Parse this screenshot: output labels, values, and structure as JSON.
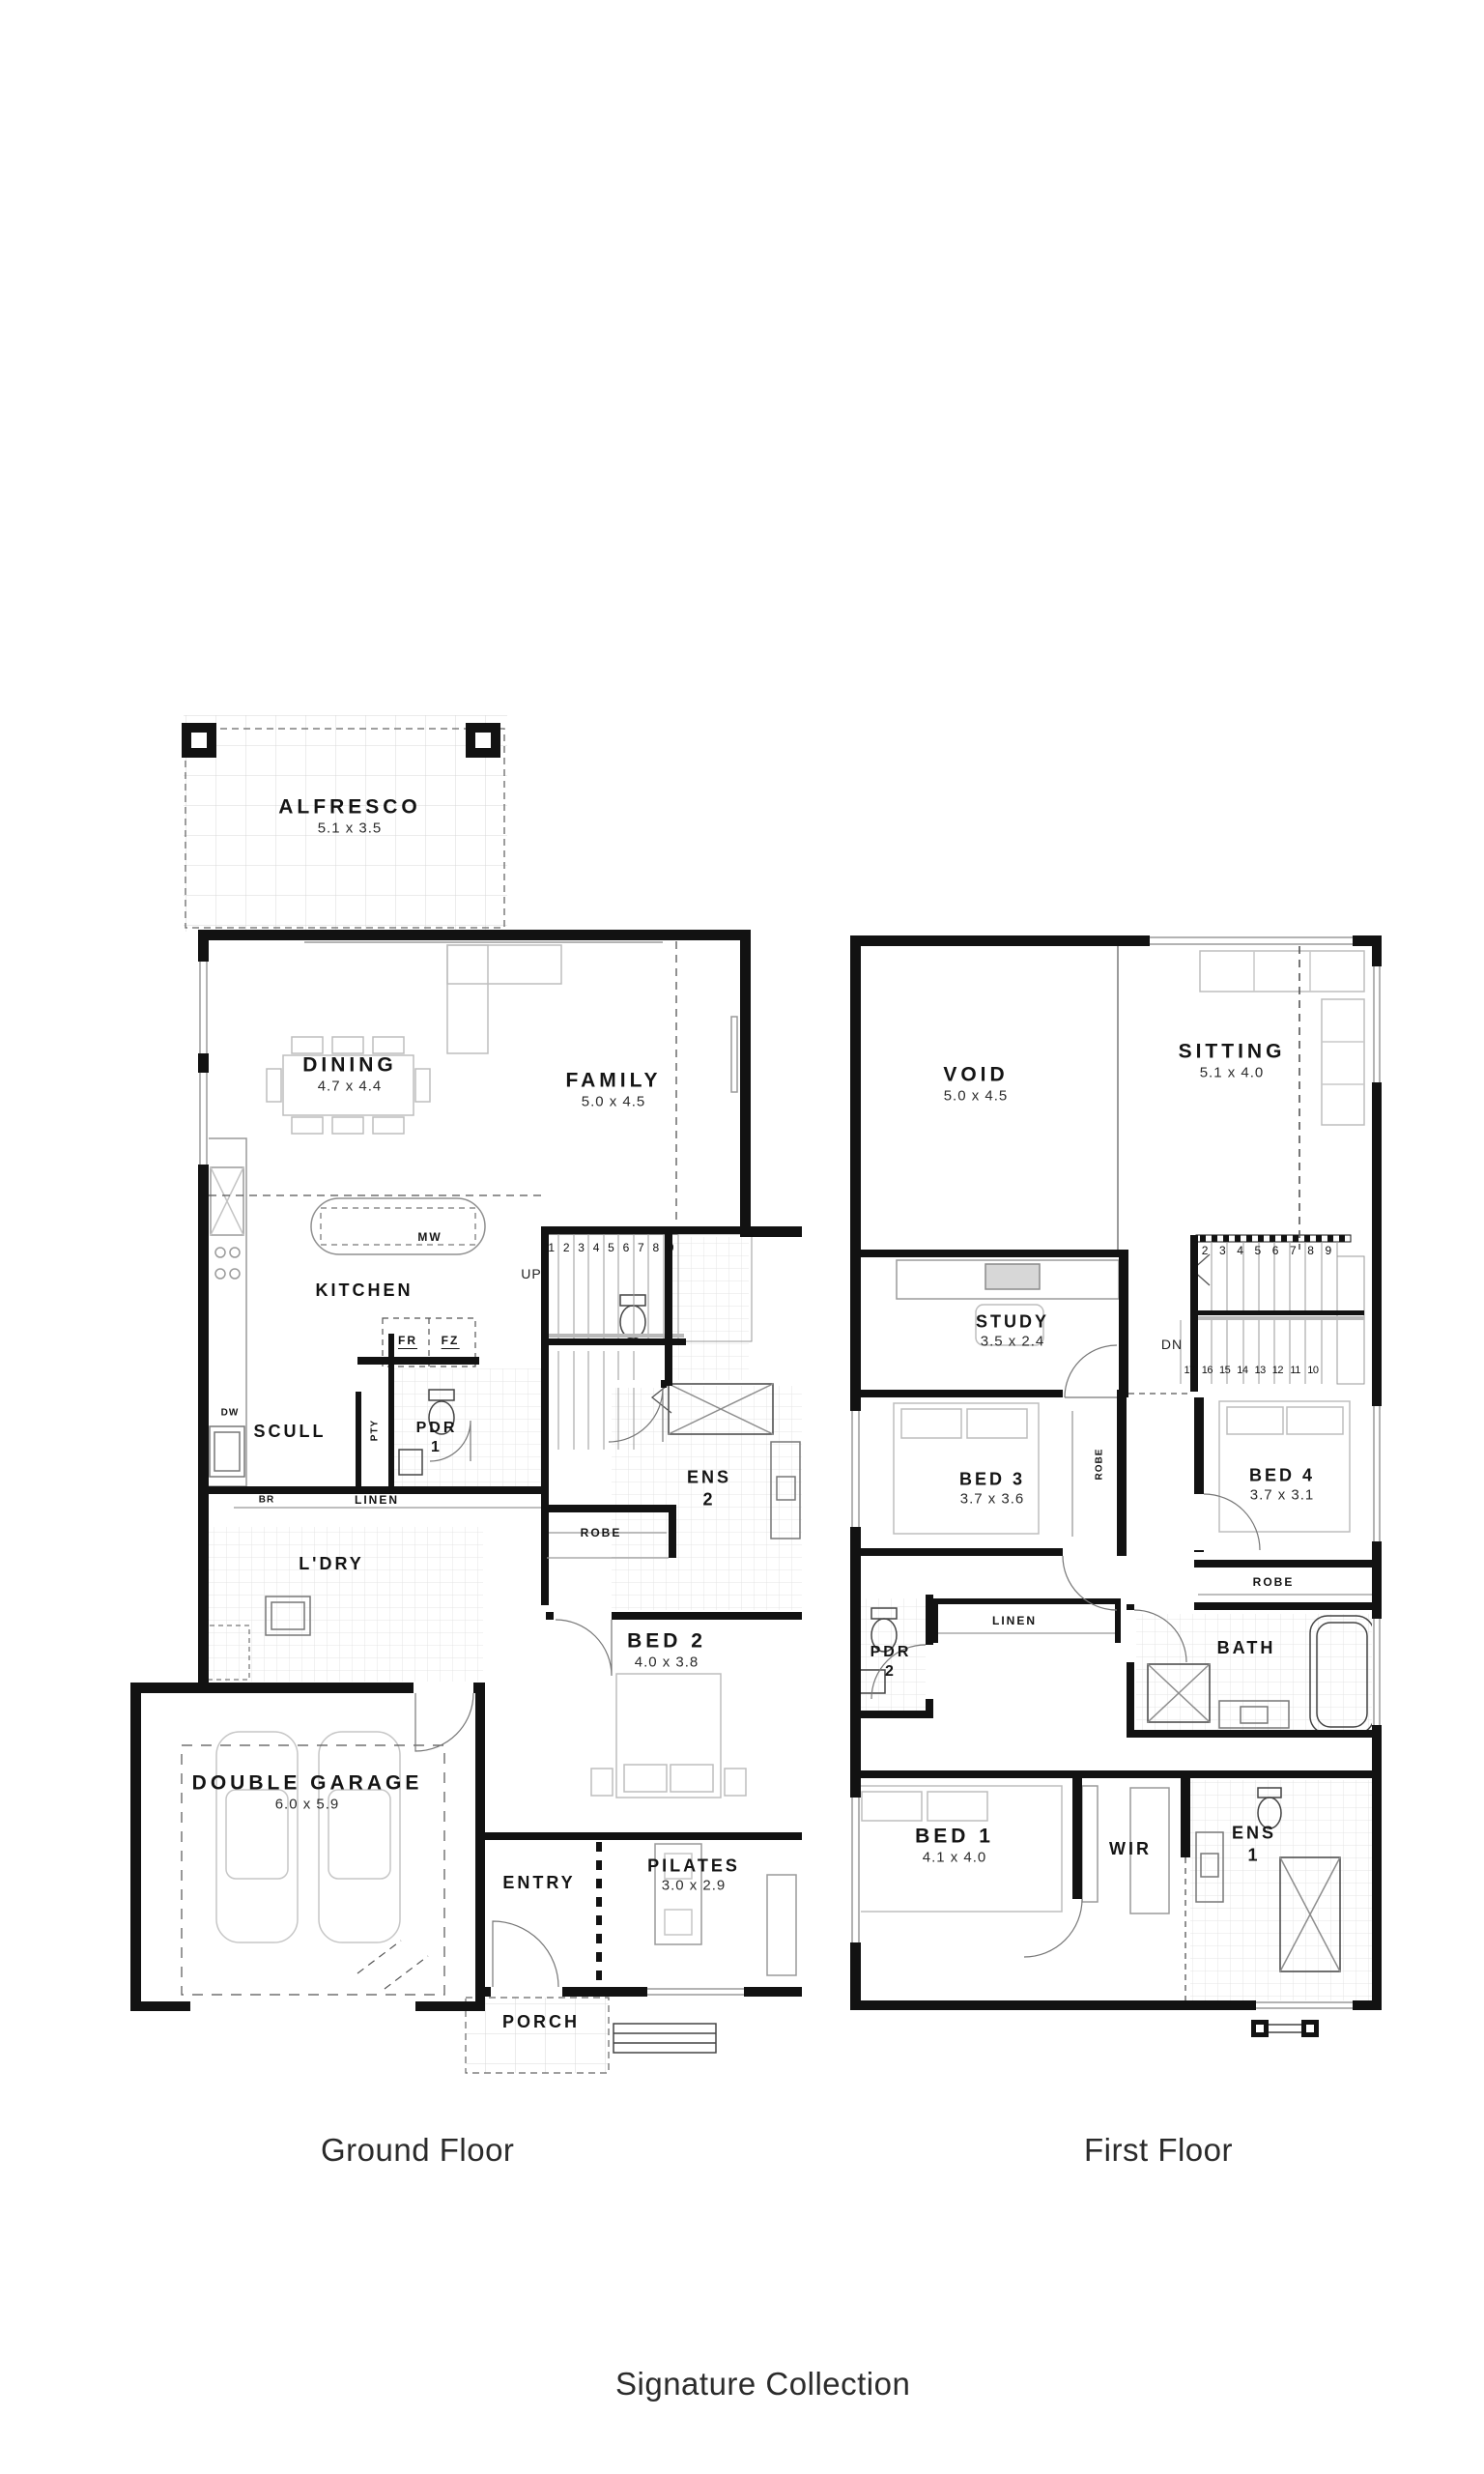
{
  "meta": {
    "collection": "Signature Collection",
    "wall_color": "#121212"
  },
  "ground": {
    "caption": "Ground Floor",
    "rooms": {
      "alfresco": {
        "name": "ALFRESCO",
        "dims": "5.1 x 3.5"
      },
      "dining": {
        "name": "DINING",
        "dims": "4.7 x 4.4"
      },
      "family": {
        "name": "FAMILY",
        "dims": "5.0 x 4.5"
      },
      "kitchen": {
        "name": "KITCHEN"
      },
      "scull": {
        "name": "SCULL"
      },
      "pdr1": {
        "name": "PDR",
        "number": "1"
      },
      "ens2": {
        "name": "ENS",
        "number": "2"
      },
      "robe": {
        "name": "ROBE"
      },
      "bed2": {
        "name": "BED 2",
        "dims": "4.0 x 3.8"
      },
      "ldry": {
        "name": "L'DRY"
      },
      "garage": {
        "name": "DOUBLE GARAGE",
        "dims": "6.0 x 5.9"
      },
      "entry": {
        "name": "ENTRY"
      },
      "pilates": {
        "name": "PILATES",
        "dims": "3.0 x 2.9"
      },
      "porch": {
        "name": "PORCH"
      }
    },
    "fixtures": {
      "mw": "MW",
      "fr": "FR",
      "fz": "FZ",
      "dw": "DW",
      "br": "BR",
      "linen": "LINEN",
      "pty": "PTY",
      "up": "UP"
    },
    "stairs": [
      "1",
      "2",
      "3",
      "4",
      "5",
      "6",
      "7",
      "8",
      "9"
    ]
  },
  "first": {
    "caption": "First Floor",
    "rooms": {
      "void": {
        "name": "VOID",
        "dims": "5.0 x 4.5"
      },
      "sitting": {
        "name": "SITTING",
        "dims": "5.1 x 4.0"
      },
      "study": {
        "name": "STUDY",
        "dims": "3.5 x 2.4"
      },
      "bed3": {
        "name": "BED 3",
        "dims": "3.7 x 3.6"
      },
      "bed4": {
        "name": "BED 4",
        "dims": "3.7 x 3.1"
      },
      "bed1": {
        "name": "BED 1",
        "dims": "4.1 x 4.0"
      },
      "bath": {
        "name": "BATH"
      },
      "wir": {
        "name": "WIR"
      },
      "pdr2": {
        "name": "PDR",
        "number": "2"
      },
      "ens1": {
        "name": "ENS",
        "number": "1"
      }
    },
    "fixtures": {
      "robe_bed3": "ROBE",
      "robe_bed4": "ROBE",
      "linen": "LINEN",
      "dn": "DN"
    },
    "stairs_upper": [
      "2",
      "3",
      "4",
      "5",
      "6",
      "7",
      "8",
      "9"
    ],
    "stairs_lower": [
      "17",
      "16",
      "15",
      "14",
      "13",
      "12",
      "11",
      "10"
    ]
  }
}
